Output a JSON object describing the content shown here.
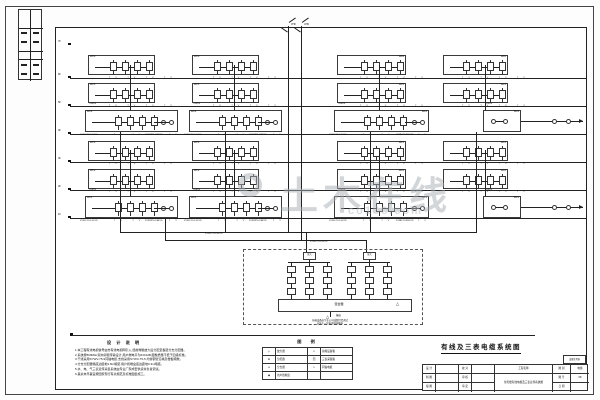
{
  "watermark": {
    "text": "土木在线",
    "sub": "co188.com"
  },
  "antennas": {
    "left": "VHF",
    "right": "UHF"
  },
  "floors": [
    "7F",
    "6F",
    "5F",
    "4F",
    "3F",
    "2F",
    "1F"
  ],
  "grid": {
    "row_labels": [
      "WF6",
      "WF5",
      "WF4",
      "WF3",
      "WF2",
      "WF1"
    ],
    "tap_terminals": "TV TV TV TV",
    "power_label": "~220V",
    "cable_left": "SYWV-75-5 SC20",
    "cable_right": "SYWV-75-9 SC25",
    "feeder_label": "SYWV-75-9 SC32"
  },
  "headend": {
    "amp_label": "放大",
    "mixer_label": "混合器",
    "out_label": "输出",
    "note_line1": "前端设备由专业公司成套供货调试",
    "note_line2": "安装于一层电视前端箱内"
  },
  "notes_title": "设 计 说 明",
  "notes_lines": [
    "1.本工程有线电视信号由市有线电视网引入,经前端箱放大后分配至各层分支分配器。",
    "2.系统按860MHz双向邻频传输设计,用户端电平为64±4dB,图像质量不低于四级标准。",
    "3.干线采用SYWV-75-9同轴电缆,支线采用SYWV-75-5,均穿钢管沿墙及楼板暗敷。",
    "4.分支分配器箱底边距地1.8m暗装,用户终端盒底边距地0.3m暗装。",
    "5.水、电、气三表远传采集系统由专业厂家成套供货并负责调试。",
    "6.其余未尽事宜按国家现行有关规范及标准图集施工。"
  ],
  "legend": {
    "title": "图 例",
    "rows": [
      {
        "s1": "▷",
        "n1": "放大器",
        "s2": "▭",
        "n2": "前端设备箱"
      },
      {
        "s1": "⊟",
        "n1": "分配器",
        "s2": "回",
        "n2": "三表采集箱"
      },
      {
        "s1": "⌀",
        "n1": "分支器",
        "s2": "∿",
        "n2": "同轴电缆"
      },
      {
        "s1": "◉",
        "n1": "用户终端盒",
        "s2": "",
        "n2": ""
      }
    ]
  },
  "drawing_title": "有线及三表电缆系统图",
  "titleblock": {
    "stamp": "出图专用章",
    "l1": "设 计",
    "l2": "制 图",
    "l3": "描 图",
    "l4": "校 对",
    "l5": "审 核",
    "l6": "审 定",
    "project_label": "工程名称",
    "project_name": "住宅楼有线电视及三表远传系统图",
    "g1": "图 别",
    "g1v": "电施",
    "g2": "图 号",
    "g2v": "08",
    "g3": "日 期",
    "g3v": ""
  }
}
